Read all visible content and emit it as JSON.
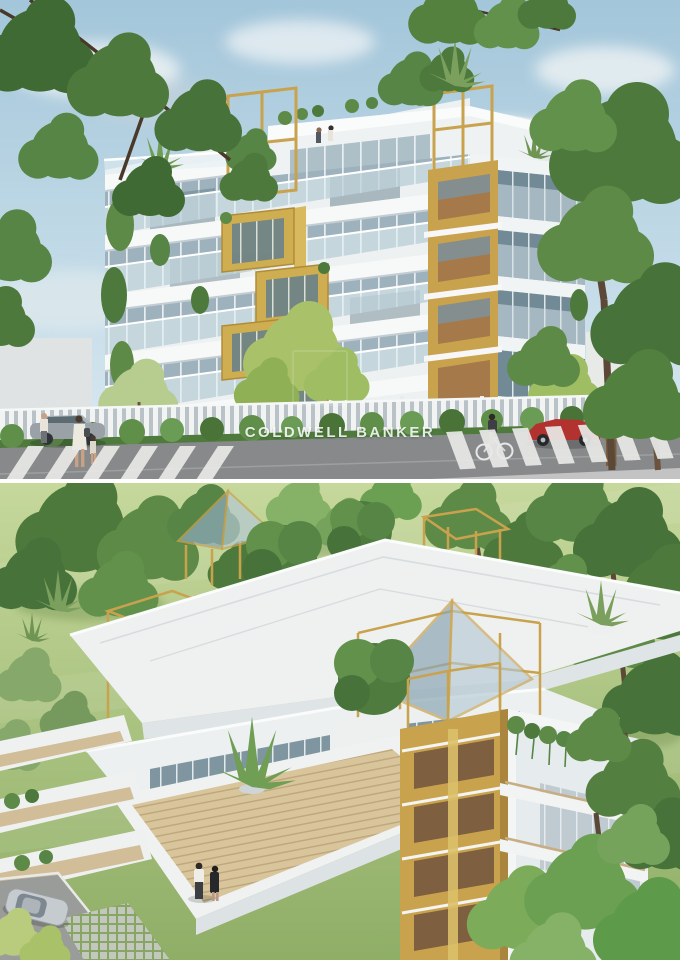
{
  "page": {
    "width": 680,
    "height": 960,
    "description": "Two stacked architectural renderings of a modern white-and-gold residential building"
  },
  "palette": {
    "sky_top": "#a3c6da",
    "sky_bottom": "#dcebf2",
    "cloud": "#f1f5f7",
    "foliage_dark": "#47723a",
    "foliage_mid": "#5d8a47",
    "foliage_light": "#83b163",
    "foliage_yellow": "#a9c168",
    "lawn_light": "#c6d89c",
    "lawn_dark": "#8fae66",
    "building_white": "#f2f4f4",
    "building_shade": "#dde3e6",
    "glass": "#9db2bc",
    "glass_dark": "#64808d",
    "gold": "#c9a24d",
    "gold_light": "#ddc172",
    "wood": "#a8835b",
    "deck_wood": "#d9c59c",
    "road": "#87898b",
    "sidewalk": "#b9bbbb",
    "crosswalk_stripe": "#e9eae8",
    "hedge": "#5f8f49",
    "car_red": "#b23230",
    "car_gray": "#9aa2a8",
    "car_silver": "#c6cbcf"
  },
  "street_view": {
    "label": "Street-level exterior rendering of apartment building",
    "watermark": "COLDWELL BANKER",
    "elements": [
      "sky with clouds",
      "white apartment building with gold accents",
      "rooftop gold pergola frames",
      "glass balconies",
      "agave roof plants",
      "street trees",
      "white slat fence",
      "hedge",
      "white planter wall",
      "zebra crosswalks",
      "red sports car",
      "grey parked car",
      "mother with child crossing",
      "woman near car",
      "cyclist",
      "man in brown suit"
    ]
  },
  "aerial_view": {
    "label": "Aerial rooftop rendering of the same building",
    "elements": [
      "lawn",
      "mature trees",
      "white roof terraces",
      "glass pyramid skylights with gold frames",
      "gold cube pergolas",
      "round topiary trees in white planters",
      "glass pavilion level",
      "wood deck terrace",
      "two residents on terrace",
      "stacked left balconies",
      "gold zigzag balcony tower",
      "side facade balconies",
      "hanging plants",
      "agave on parapet",
      "silver parked car",
      "driveway with grass-grid paving"
    ]
  }
}
